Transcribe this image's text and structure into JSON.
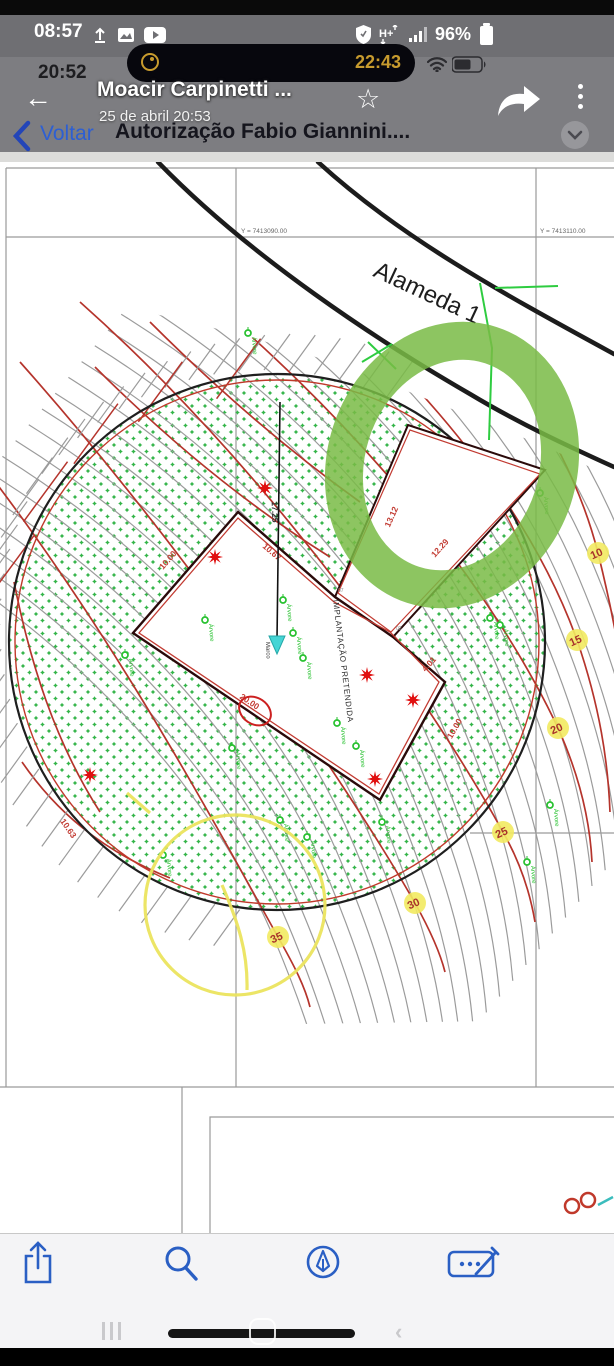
{
  "status_bar_outer": {
    "time": "08:57",
    "battery_percent": "96%",
    "left_icons": [
      "upload-icon",
      "gallery-icon",
      "youtube-icon"
    ],
    "right_icons": [
      "vpn-shield-icon",
      "hplus-network-icon",
      "signal-bars-icon",
      "battery-icon"
    ],
    "network_label": "H+"
  },
  "status_bar_inner": {
    "time": "20:52",
    "timer_time": "22:43",
    "right_icons": [
      "wifi-icon",
      "battery-icon"
    ]
  },
  "media_header": {
    "title": "Moacir Carpinetti ...",
    "subtitle": "25 de abril 20:53",
    "icons": [
      "back-arrow-icon",
      "star-icon",
      "forward-share-icon",
      "kebab-menu-icon"
    ],
    "back_glyph": "←",
    "star_glyph": "☆"
  },
  "nav_bar": {
    "back_label": "Voltar",
    "title": "Autorização Fabio Giannini....",
    "icons": [
      "back-chevron-icon",
      "collapse-chevron-icon"
    ]
  },
  "drawing": {
    "street_label": "Alameda 1",
    "grid_y_labels": [
      "Y = 7413090.00",
      "Y = 7413110.00"
    ],
    "building_label": "IMPLANTAÇÃO PRETENDIDA",
    "marco_label": "Marco",
    "tree_label": "Árvore",
    "dimensions": [
      "10.00",
      "10.67",
      "17.25",
      "13.12",
      "12.29",
      "4.01",
      "10.00",
      "20.00",
      "10.63"
    ],
    "contour_labels": [
      "10",
      "15",
      "20",
      "25",
      "30",
      "35"
    ],
    "corner_labels": [
      "07",
      "03"
    ],
    "colors": {
      "vegetation_green": "#35b54a",
      "tree_marker_green": "#27c12f",
      "contour_red": "#b5342c",
      "contour_gray": "#9b9b9b",
      "annotation_green": "#79bb45",
      "highlight_yellow": "#f2ea60",
      "marco_cyan": "#45d5d5",
      "star_red": "#e01010",
      "road_black": "#1c1c1c",
      "dimension_red": "#c23b32",
      "grid_gray": "#9a9a9a",
      "annotation_yellow": "#ece45e"
    }
  },
  "toolbar": {
    "icons": [
      "share-icon",
      "search-icon",
      "markup-pen-icon",
      "signature-field-icon"
    ]
  },
  "android_nav": {
    "icons": [
      "recents-icon",
      "home-pill",
      "back-icon"
    ],
    "back_glyph": "‹"
  }
}
